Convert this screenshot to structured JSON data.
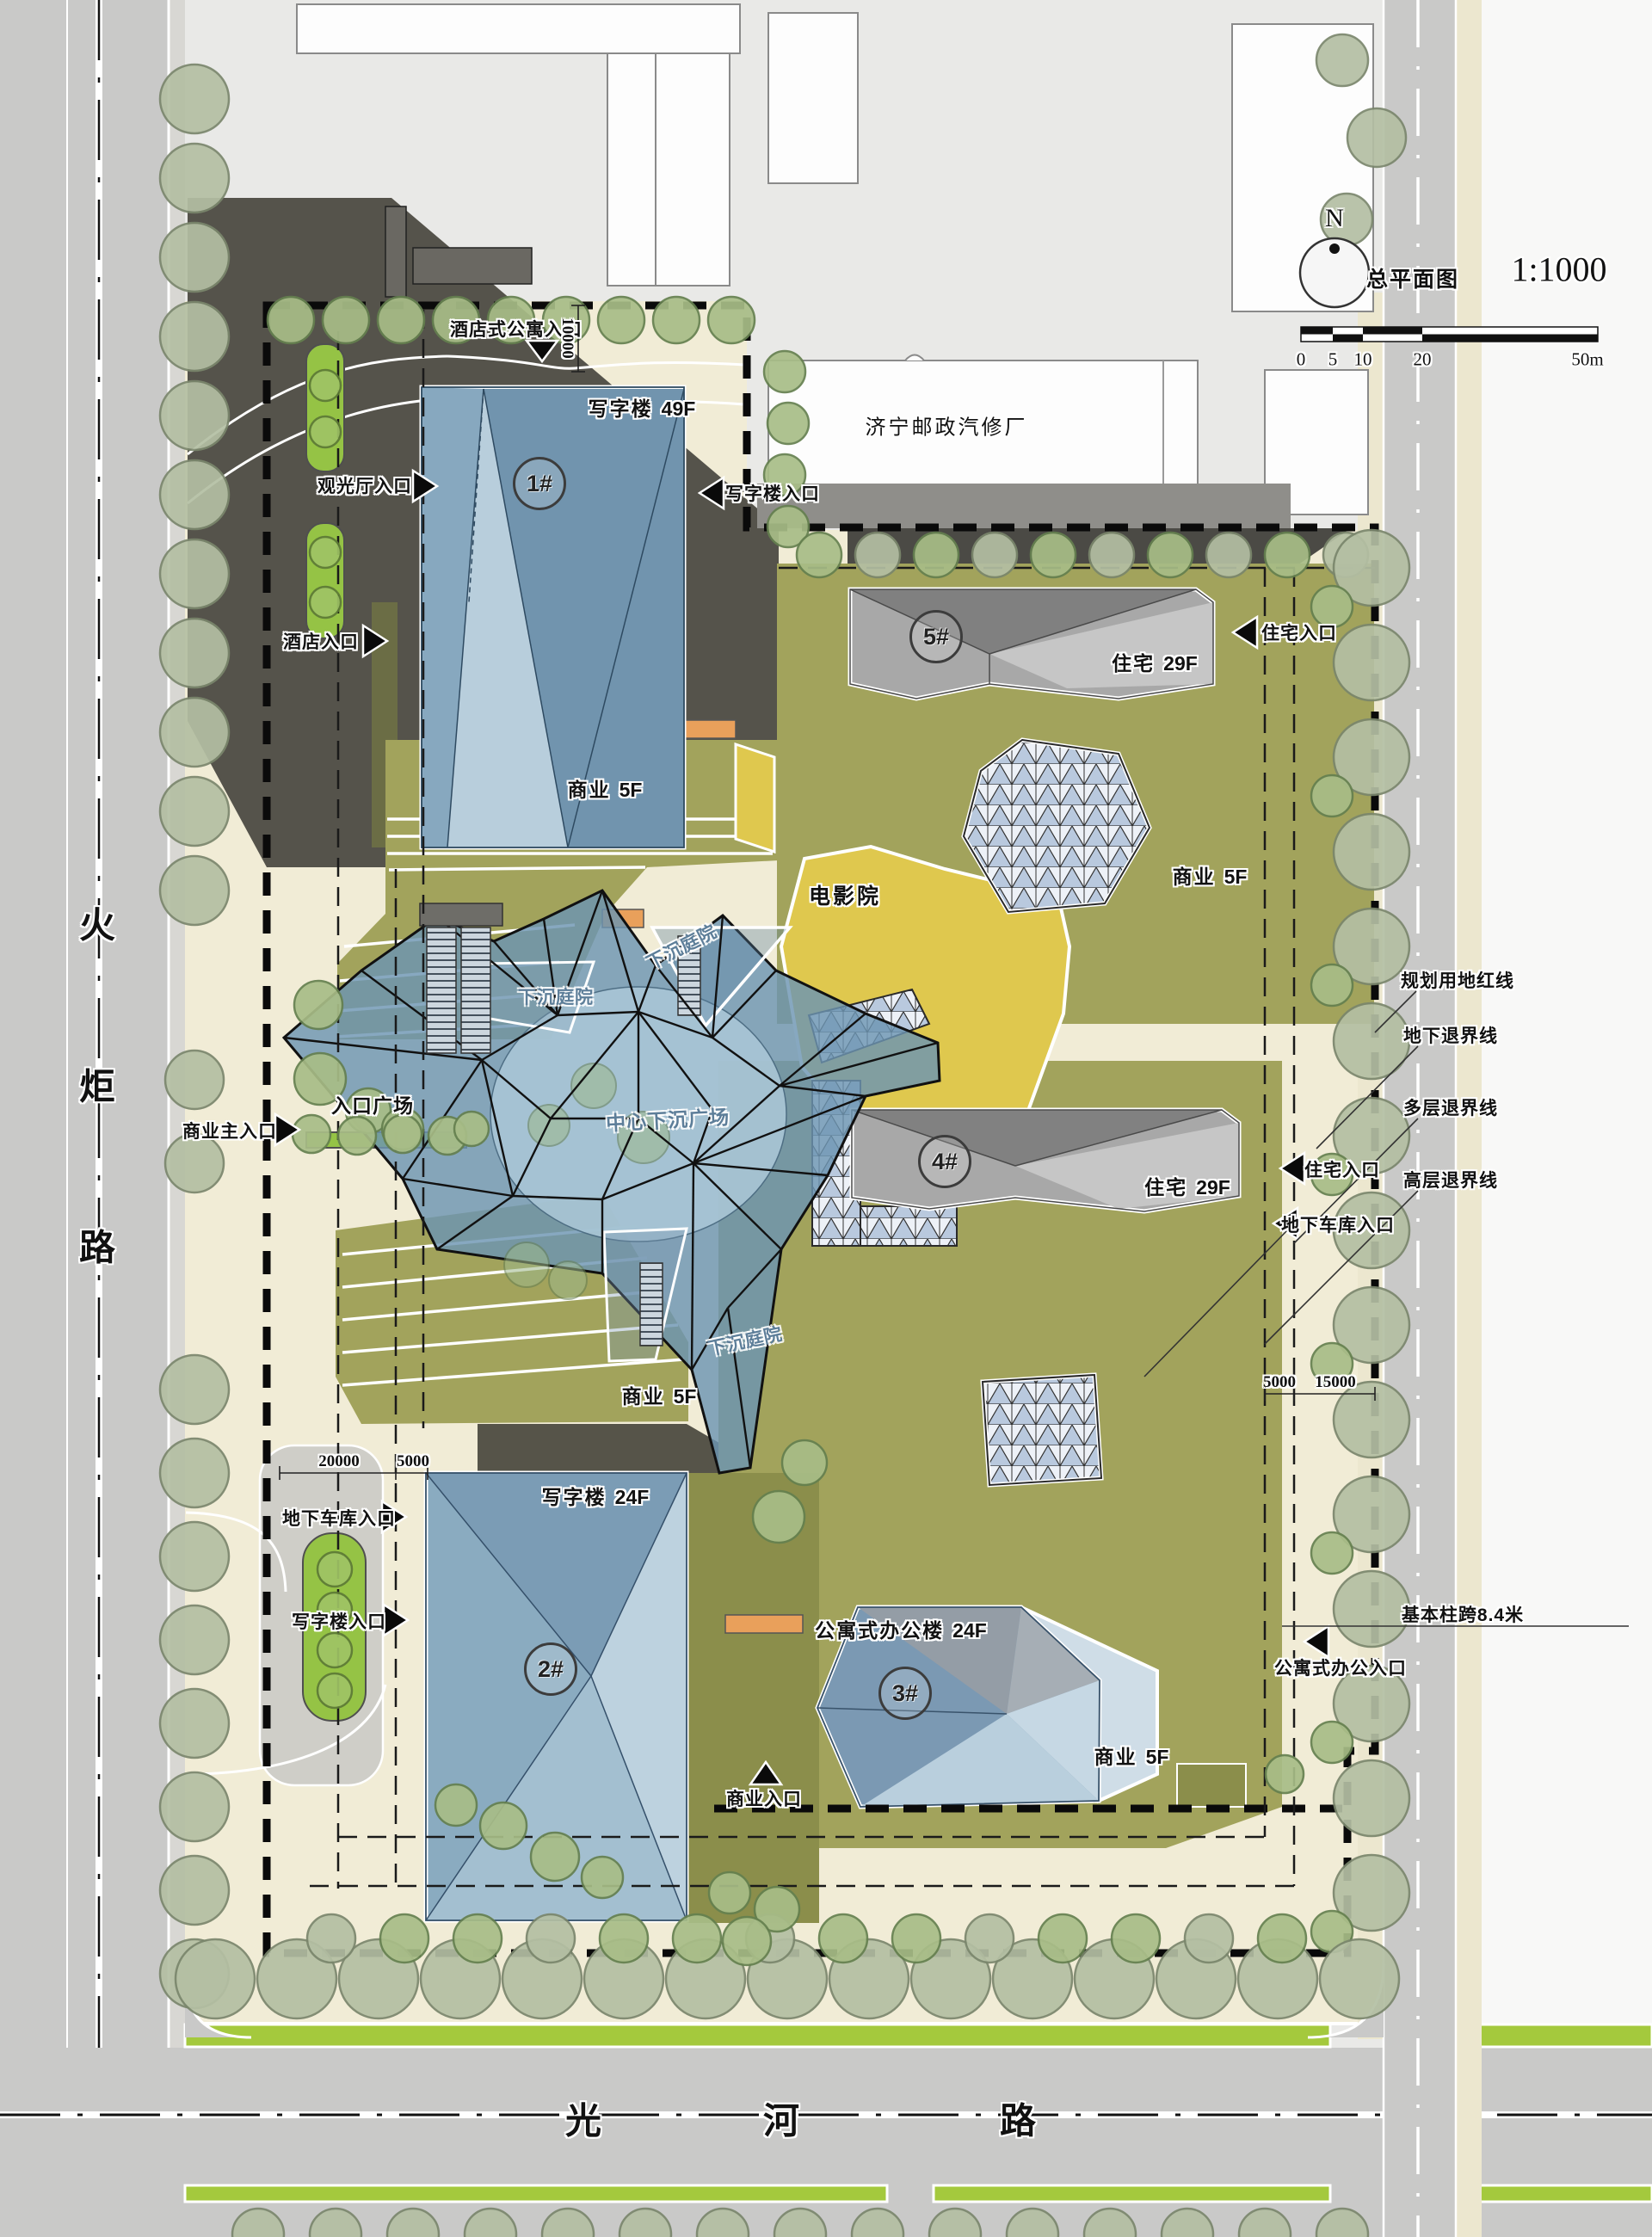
{
  "map_title": {
    "plan_label": "总平面图",
    "scale_text": "1:1000",
    "north_letter": "N",
    "scale_ticks": [
      "0",
      "5",
      "10",
      "20"
    ],
    "scale_end": "50m"
  },
  "roads": {
    "west": [
      "火",
      "炬",
      "路"
    ],
    "south": [
      "光",
      "河",
      "路"
    ]
  },
  "adjacent_building": {
    "name": "济宁邮政汽修厂"
  },
  "buildings": {
    "b1": {
      "id": "1#",
      "use": "写字楼",
      "floors": "49F"
    },
    "b2": {
      "id": "2#",
      "use": "写字楼",
      "floors": "24F"
    },
    "b3": {
      "id": "3#",
      "use": "公寓式办公楼",
      "floors": "24F"
    },
    "b4": {
      "id": "4#",
      "use": "住宅",
      "floors": "29F"
    },
    "b5": {
      "id": "5#",
      "use": "住宅",
      "floors": "29F"
    }
  },
  "places": {
    "cinema": "电影院",
    "commercial": "商业",
    "commercial_floors": "5F",
    "sunken_courtyard": "下沉庭院",
    "central_sunken_plaza": "中心下沉广场",
    "entrance_plaza": "入口广场"
  },
  "entrances": {
    "hotel_apartment": "酒店式公寓入口",
    "observation_hall": "观光厅入口",
    "hotel": "酒店入口",
    "office_ne": "写字楼入口",
    "residence_ne": "住宅入口",
    "commercial_main": "商业主入口",
    "residence_e": "住宅入口",
    "garage_e": "地下车库入口",
    "garage_sw": "地下车库入口",
    "office_sw": "写字楼入口",
    "commercial_s": "商业入口",
    "apartment_office_se": "公寓式办公入口"
  },
  "boundary_lines": {
    "red_line": "规划用地红线",
    "underground_setback": "地下退界线",
    "multistorey_setback": "多层退界线",
    "highrise_setback": "高层退界线"
  },
  "dimensions": {
    "d10000": "10000",
    "d20000": "20000",
    "d5000_w": "5000",
    "d5000_e": "5000",
    "d15000": "15000",
    "column_span": "基本柱跨8.4米"
  }
}
